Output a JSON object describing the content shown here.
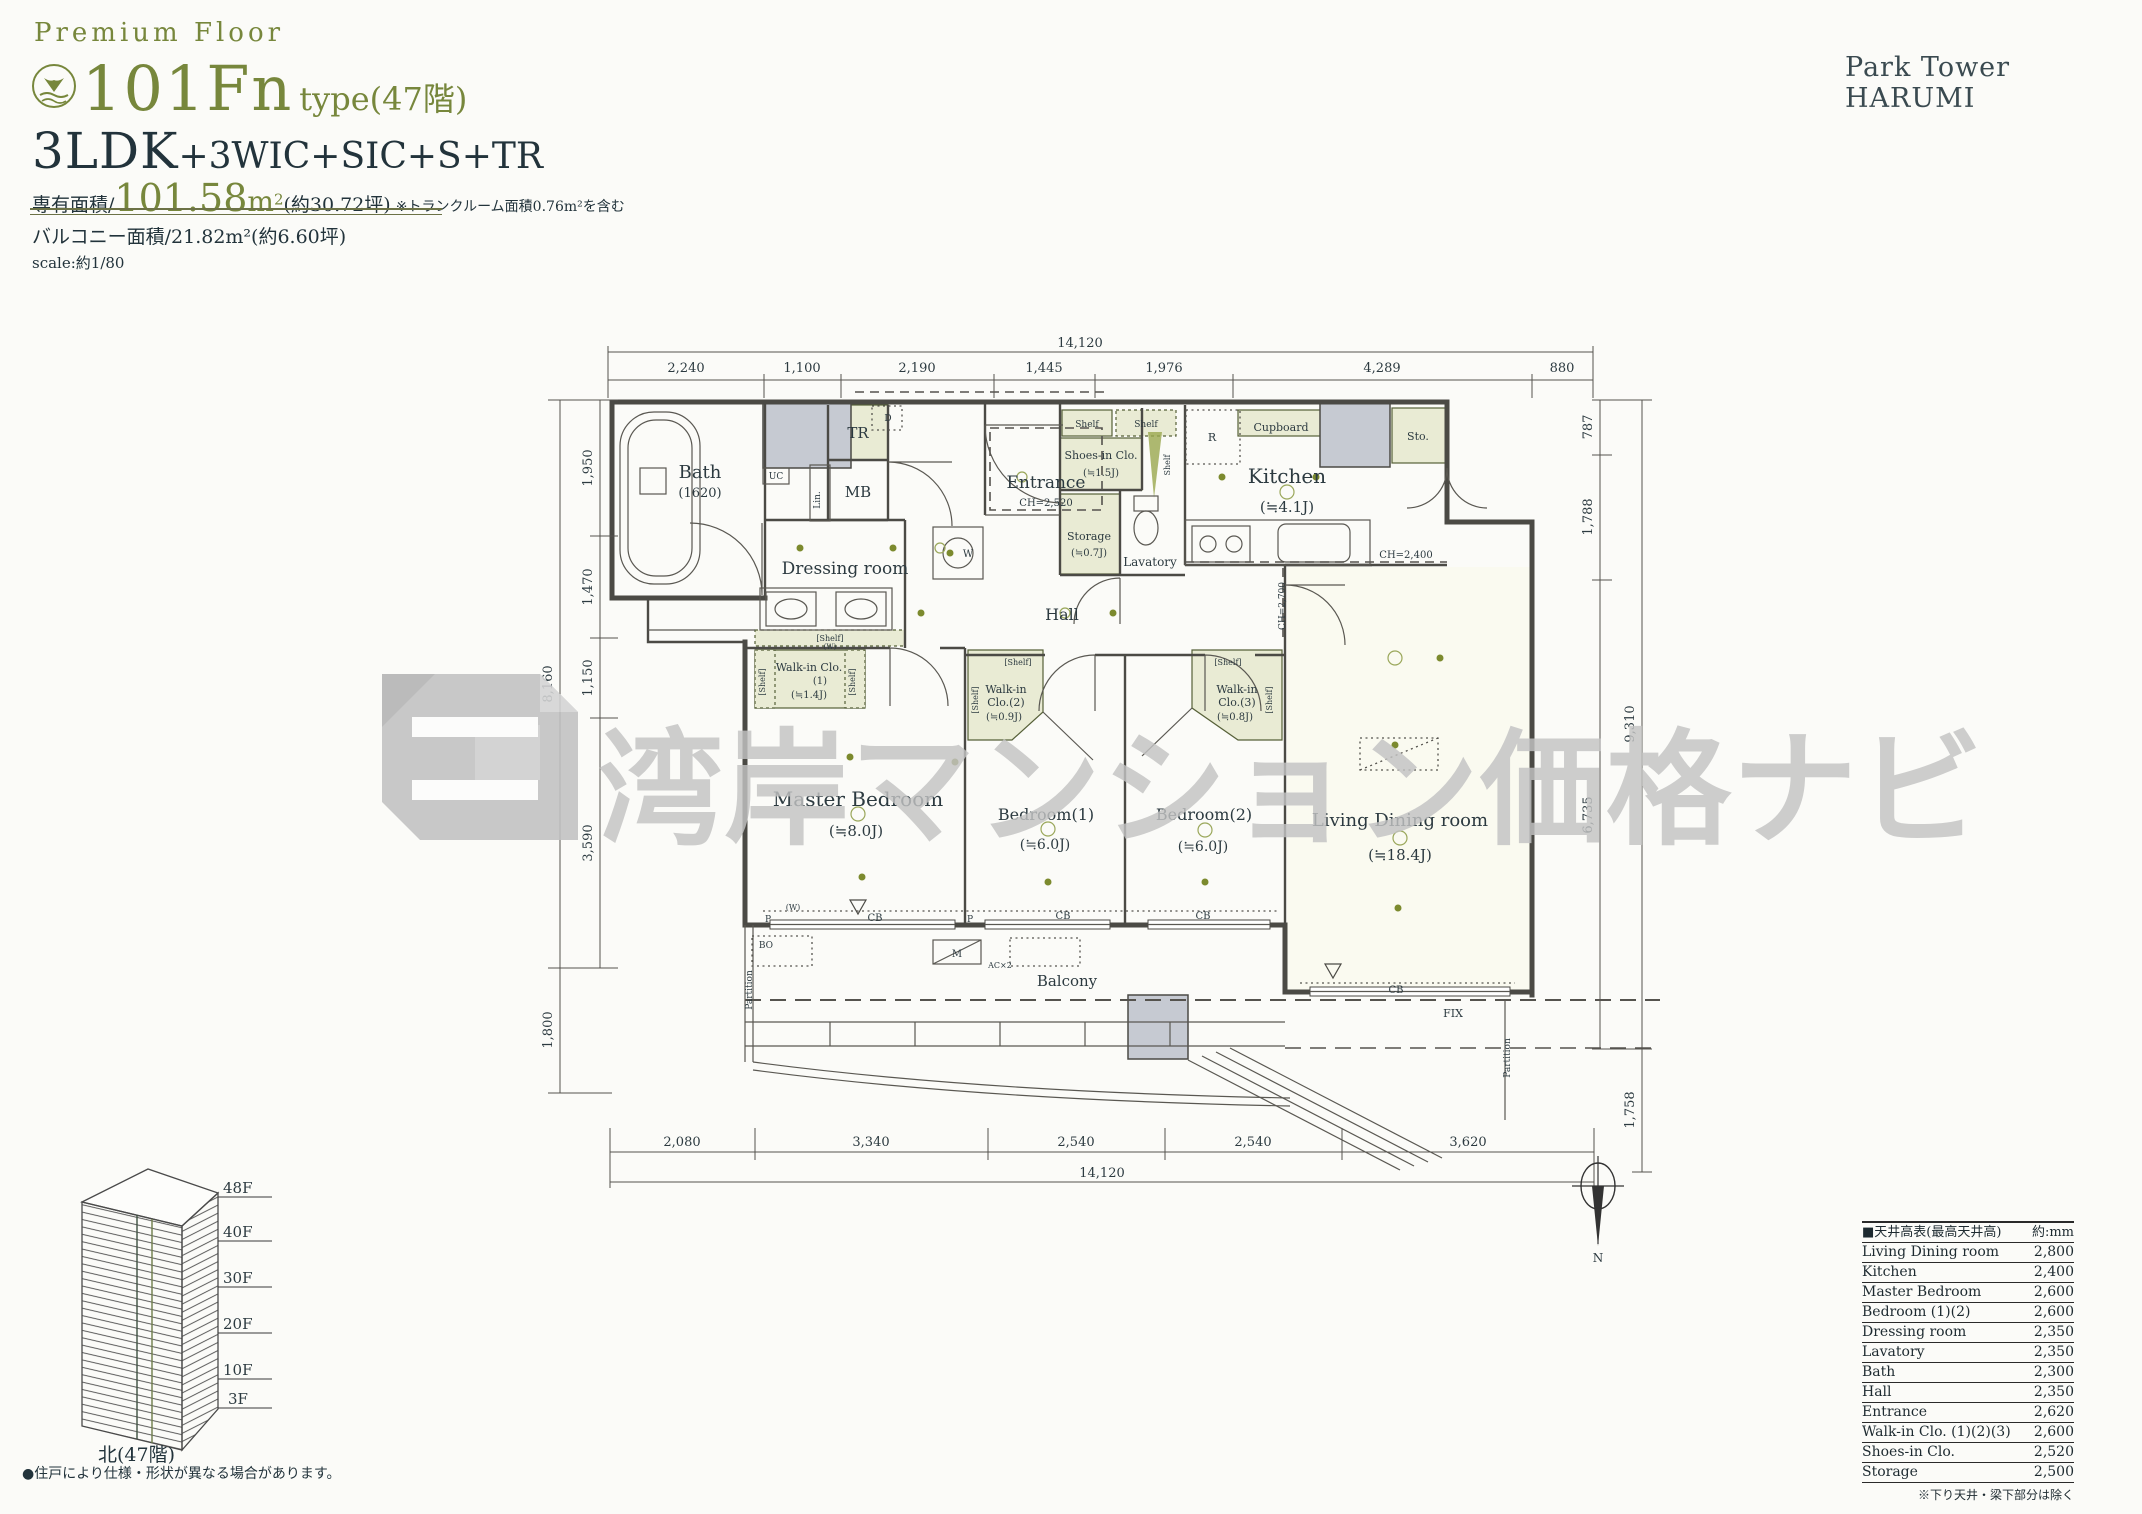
{
  "page": {
    "brand": "Park Tower HARUMI"
  },
  "header": {
    "eyebrow": "Premium Floor",
    "type_name": "101Fn",
    "type_suffix": "type(47階)",
    "layout_main": "3LDK",
    "layout_suffix": "+3WIC+SIC+S+TR",
    "area_prefix": "専有面積/",
    "area_value": "101.58",
    "area_unit": "m",
    "area_sup": "2",
    "area_tsubo": "(約30.72坪)",
    "area_note": "※トランクルーム面積0.76m²を含む",
    "balcony_line": "バルコニー面積/21.82m²(約6.60坪)",
    "scale_line": "scale:約1/80"
  },
  "watermark": {
    "text": "湾岸マンション価格ナビ"
  },
  "plan": {
    "rooms": {
      "bath": {
        "name": "Bath",
        "size": "(1620)"
      },
      "dressing": {
        "name": "Dressing room"
      },
      "tr": {
        "name": "TR"
      },
      "mb": {
        "name": "MB"
      },
      "entrance": {
        "name": "Entrance",
        "ch": "CH=2,520"
      },
      "shoes": {
        "name": "Shoes-in Clo.",
        "size": "(≒1.5J)"
      },
      "storage": {
        "name": "Storage",
        "size": "(≒0.7J)"
      },
      "lavatory": {
        "name": "Lavatory"
      },
      "kitchen": {
        "name": "Kitchen",
        "size": "(≒4.1J)",
        "ch": "CH=2,400"
      },
      "cupboard": {
        "name": "Cupboard"
      },
      "r": {
        "name": "R"
      },
      "sto": {
        "name": "Sto."
      },
      "hall": {
        "name": "Hall"
      },
      "wic1": {
        "l1": "Walk-in Clo.",
        "l2": "(1)",
        "size": "(≒1.4J)"
      },
      "wic2": {
        "l1": "Walk-in",
        "l2": "Clo.(2)",
        "size": "(≒0.9J)"
      },
      "wic3": {
        "l1": "Walk-in",
        "l2": "Clo.(3)",
        "size": "(≒0.8J)"
      },
      "master": {
        "name": "Master Bedroom",
        "size": "(≒8.0J)"
      },
      "bed1": {
        "name": "Bedroom(1)",
        "size": "(≒6.0J)"
      },
      "bed2": {
        "name": "Bedroom(2)",
        "size": "(≒6.0J)"
      },
      "ldk": {
        "name": "Living Dining room",
        "size": "(≒18.4J)"
      },
      "balcony": {
        "name": "Balcony"
      }
    },
    "labels": {
      "shelf": "[Shelf]",
      "shelf_plain": "Shelf",
      "shelf_w": "(W)",
      "partition": "Partition",
      "fix": "FIX",
      "cb": "CB",
      "m": "M",
      "bo": "BO",
      "p": "P",
      "w": "W",
      "uc": "UC",
      "lin": "Lin.",
      "d": "D",
      "ac": "AC×2",
      "ch2700": "CH=2,700",
      "n": "N"
    },
    "dims": {
      "top": {
        "total": "14,120",
        "segs": [
          "2,240",
          "1,100",
          "2,190",
          "1,445",
          "1,976",
          "4,289",
          "880"
        ]
      },
      "bottom": {
        "total": "14,120",
        "segs": [
          "2,080",
          "3,340",
          "2,540",
          "2,540",
          "3,620"
        ]
      },
      "left": {
        "total": "8,160",
        "segs": [
          "1,950",
          "1,470",
          "1,150",
          "3,590"
        ],
        "below": "1,800"
      },
      "right": {
        "total": "9,310",
        "segs": [
          "787",
          "1,788",
          "6,735"
        ],
        "below": "1,758"
      }
    }
  },
  "elevation": {
    "floors": [
      "48F",
      "40F",
      "30F",
      "20F",
      "10F",
      "3F"
    ],
    "caption": "北(47階)",
    "note": "●住戸により仕様・形状が異なる場合があります。"
  },
  "ceiling_table": {
    "title": "■天井高表(最高天井高)",
    "unit": "約:mm",
    "rows": [
      {
        "room": "Living Dining room",
        "h": "2,800"
      },
      {
        "room": "Kitchen",
        "h": "2,400"
      },
      {
        "room": "Master Bedroom",
        "h": "2,600"
      },
      {
        "room": "Bedroom (1)(2)",
        "h": "2,600"
      },
      {
        "room": "Dressing room",
        "h": "2,350"
      },
      {
        "room": "Lavatory",
        "h": "2,350"
      },
      {
        "room": "Bath",
        "h": "2,300"
      },
      {
        "room": "Hall",
        "h": "2,350"
      },
      {
        "room": "Entrance",
        "h": "2,620"
      },
      {
        "room": "Walk-in Clo. (1)(2)(3)",
        "h": "2,600"
      },
      {
        "room": "Shoes-in Clo.",
        "h": "2,520"
      },
      {
        "room": "Storage",
        "h": "2,500"
      }
    ],
    "footnote": "※下り天井・梁下部分は除く"
  }
}
